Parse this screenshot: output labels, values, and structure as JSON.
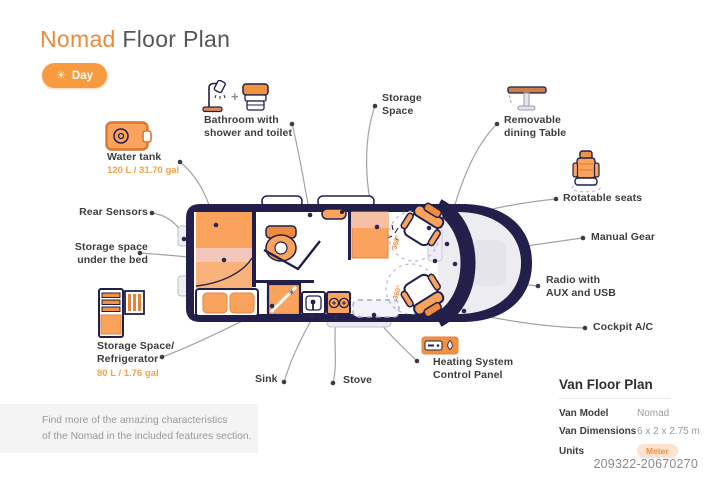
{
  "title": {
    "brand": "Nomad",
    "rest": "Floor Plan"
  },
  "mode_badge": {
    "icon": "sun-icon",
    "label": "Day"
  },
  "callouts": {
    "bathroom": {
      "line1": "Bathroom with",
      "line2": "shower and toilet",
      "icons": [
        "shower-icon",
        "toilet-icon"
      ],
      "plus": "+"
    },
    "water_tank": {
      "name": "Water tank",
      "capacity": "120 L / 31.70 gal",
      "icon": "water-tank-icon"
    },
    "storage_space": {
      "line1": "Storage",
      "line2": "Space"
    },
    "dining_table": {
      "line1": "Removable",
      "line2": "dining Table",
      "icon": "dining-table-icon"
    },
    "rotatable_seats": {
      "name": "Rotatable seats",
      "icon": "seat-icon"
    },
    "manual_gear": {
      "name": "Manual Gear"
    },
    "radio": {
      "line1": "Radio with",
      "line2": "AUX and USB"
    },
    "cockpit_ac": {
      "name": "Cockpit A/C"
    },
    "rear_sensors": {
      "name": "Rear Sensors"
    },
    "storage_under_bed": {
      "line1": "Storage space",
      "line2": "under the bed"
    },
    "refrigerator": {
      "line1": "Storage Space/",
      "line2": "Refrigerator",
      "capacity": "80 L / 1.76 gal",
      "icon": "refrigerator-icon"
    },
    "sink": {
      "name": "Sink"
    },
    "stove": {
      "name": "Stove"
    },
    "heating": {
      "line1": "Heating System",
      "line2": "Control Panel",
      "icon": "heating-panel-icon"
    }
  },
  "floorplan": {
    "seat_rotation": "360°",
    "snowflake": "✳"
  },
  "info_panel": {
    "title": "Van Floor Plan",
    "rows": [
      {
        "label": "Van Model",
        "value": "Nomad"
      },
      {
        "label": "Van Dimensions",
        "value": "6 x 2 x 2.75 m"
      },
      {
        "label": "Units",
        "value": "Meter"
      }
    ]
  },
  "note": {
    "line1": "Find more of the amazing characteristics",
    "line2": "of the Nomad in the included features section."
  },
  "footer_id": "209322-20670270",
  "colors": {
    "accent_orange": "#F0923F",
    "light_orange": "#F9A35C",
    "pale_pink": "#F2C6B9",
    "navy": "#221F4B",
    "label_text": "#3D3D3D",
    "leader_line": "#A3A3A3",
    "note_bg": "#F4F4F4"
  }
}
